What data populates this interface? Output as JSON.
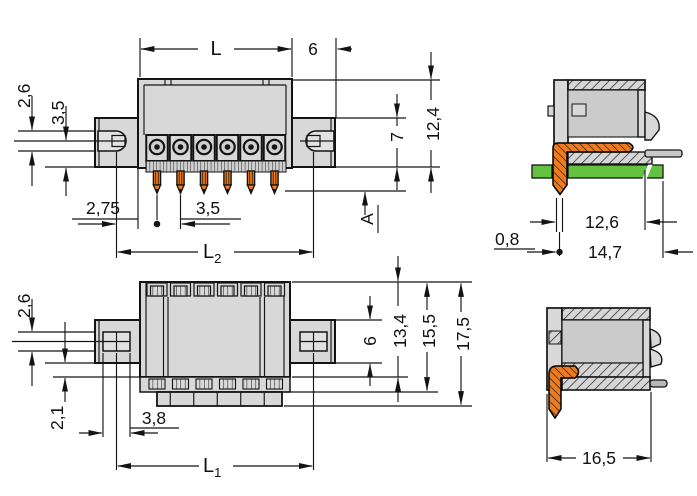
{
  "dims": {
    "front": {
      "overall_width": "L",
      "flange_overhang": "6",
      "top_left_small": "2,6",
      "mid_left_small": "3,5",
      "edge_offset": "2,75",
      "pin_pitch": "3,5",
      "L2_main": "L",
      "L2_sub": "2",
      "flange_height": "7",
      "overall_height": "12,4",
      "solder_pin_length": "A"
    },
    "side_top": {
      "pin_width": "0,8",
      "depth_to_wall": "12,6",
      "overall_depth": "14,7"
    },
    "top": {
      "top_left_small": "2,6",
      "bottom_left_small": "2,1",
      "slot_width": "3,8",
      "L1_main": "L",
      "L1_sub": "1",
      "flange_height": "6",
      "body_depth": "13,4",
      "mid_depth": "15,5",
      "overall_depth": "17,5"
    },
    "side_bottom": {
      "overall_depth": "16,5"
    }
  },
  "colors": {
    "housing_gray": "#d8d8d8",
    "cavity_gray": "#cbcbcb",
    "pin_orange": "#ee7c1e",
    "pcb_green": "#63c341",
    "line_black": "#141414"
  }
}
